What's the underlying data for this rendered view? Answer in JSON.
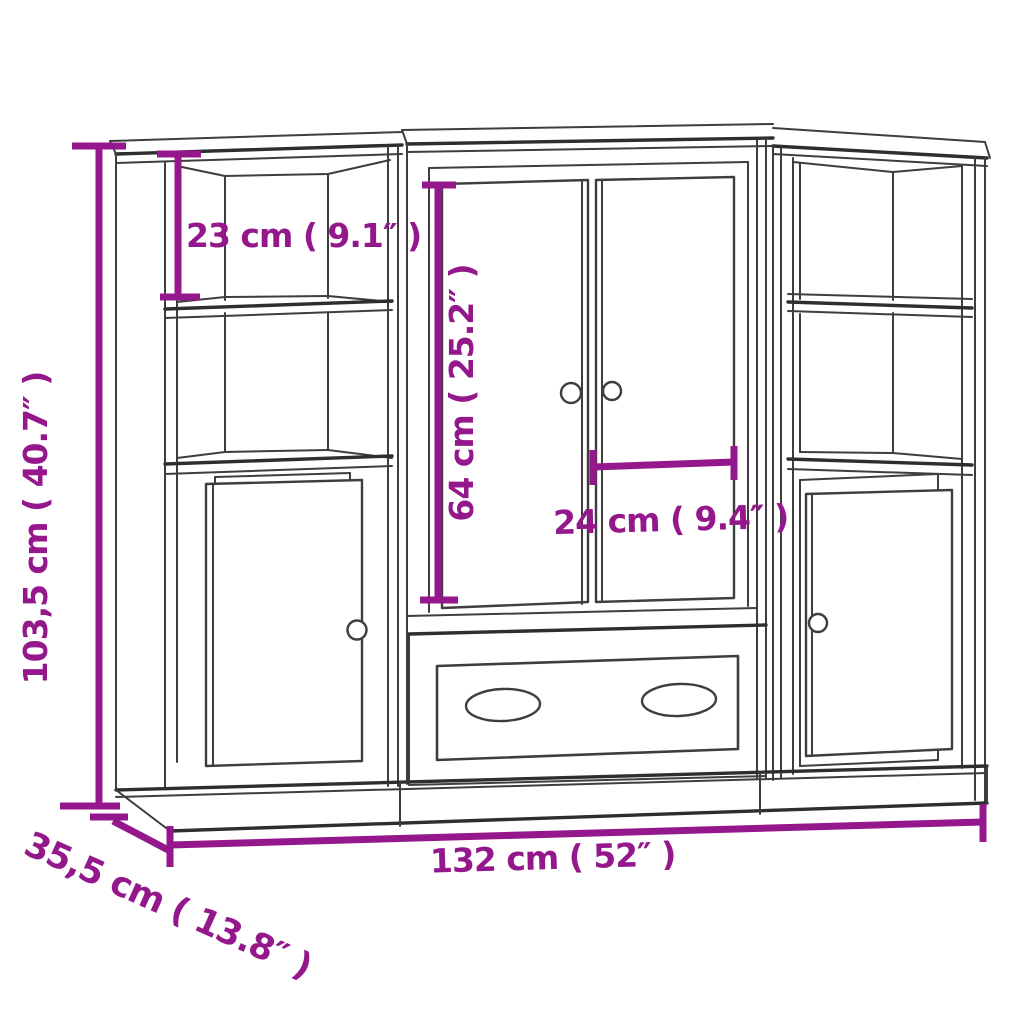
{
  "diagram": {
    "kind": "furniture-dimension-diagram",
    "subject": "highboard cabinet with two side shelf units, double center doors and drawer",
    "background_color": "#FFFFFF",
    "outline_color": "#3E3E3E",
    "accent_color": "#94188C",
    "dimensions": {
      "overall_height": {
        "label": "103,5 cm ( 40.7″ )",
        "cm": "103,5",
        "inches": "40.7",
        "orientation": "vertical-left"
      },
      "top_compartment_height": {
        "label": "23 cm ( 9.1″ )",
        "cm": "23",
        "inches": "9.1",
        "orientation": "vertical-inside-left-unit"
      },
      "center_door_height": {
        "label": "64 cm ( 25.2″ )",
        "cm": "64",
        "inches": "25.2",
        "orientation": "vertical-inside-center-doors"
      },
      "center_door_width": {
        "label": "24 cm ( 9.4″ )",
        "cm": "24",
        "inches": "9.4",
        "orientation": "horizontal-on-right-door"
      },
      "overall_width": {
        "label": "132 cm ( 52″  )",
        "cm": "132",
        "inches": "52",
        "orientation": "horizontal-bottom"
      },
      "overall_depth": {
        "label": "35,5 cm ( 13.8″  )",
        "cm": "35,5",
        "inches": "13.8",
        "orientation": "diagonal-bottom-left"
      }
    }
  }
}
